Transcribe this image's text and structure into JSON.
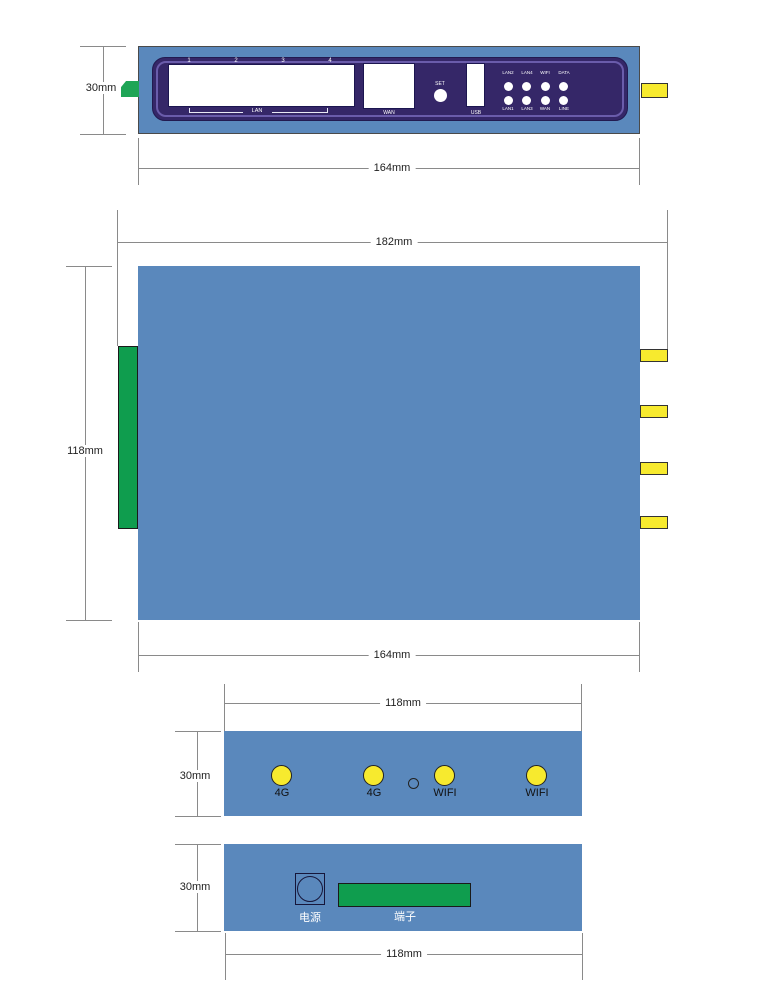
{
  "colors": {
    "casing_blue": "#5a88bc",
    "panel_purple": "#352768",
    "bezel_light_purple": "#6a5cab",
    "connector_green": "#0f9d4e",
    "antenna_yellow": "#f7ea2e",
    "led_white": "#ffffff",
    "dimension_line_gray": "#8a8a8a",
    "text_dark": "#222222"
  },
  "front_view": {
    "dims": {
      "height": "30mm",
      "width": "164mm"
    },
    "lan_numbers": [
      "1",
      "2",
      "3",
      "4"
    ],
    "labels": {
      "lan": "LAN",
      "wan": "WAN",
      "set": "SET",
      "usb": "USB"
    },
    "leds": {
      "top": [
        "LAN2",
        "LAN4",
        "WIFI",
        "DATA"
      ],
      "bottom": [
        "LAN1",
        "LAN3",
        "WAN",
        "LINE"
      ]
    }
  },
  "top_view": {
    "dims": {
      "outer_width": "182mm",
      "height": "118mm",
      "body_width": "164mm"
    }
  },
  "antenna_view": {
    "dims": {
      "width": "118mm",
      "height": "30mm"
    },
    "antenna_labels": [
      "4G",
      "4G",
      "WIFI",
      "WIFI"
    ]
  },
  "rear_view": {
    "dims": {
      "height": "30mm",
      "width": "118mm"
    },
    "labels": {
      "power": "电源",
      "terminal": "端子"
    }
  }
}
